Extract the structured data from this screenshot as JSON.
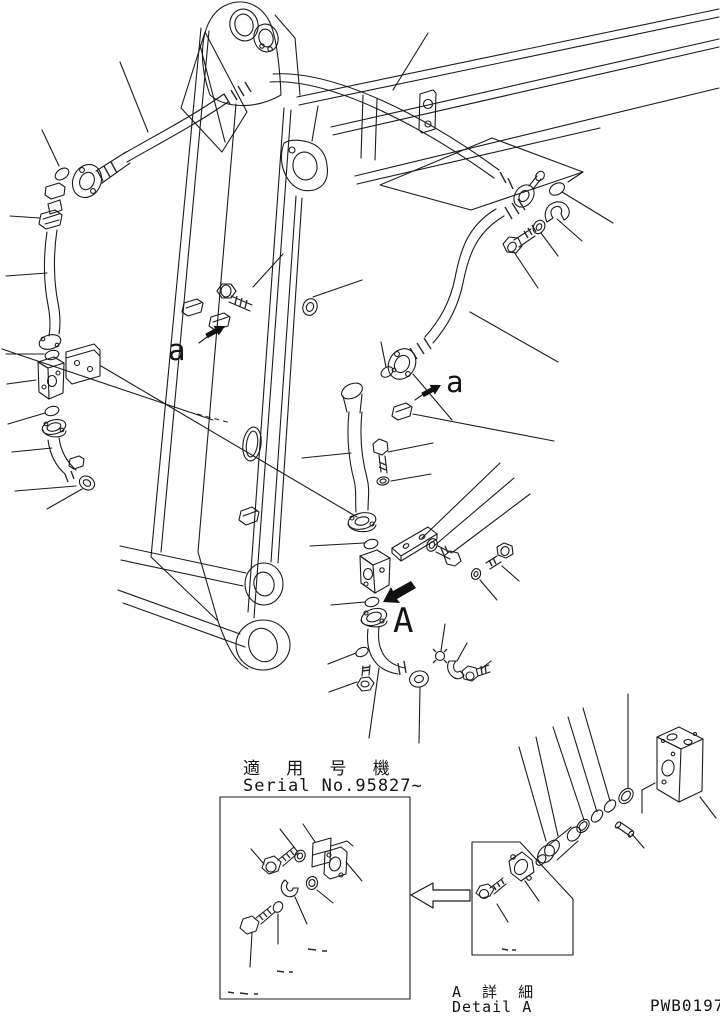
{
  "drawing": {
    "ink": "#1b1b1b",
    "background": "#ffffff",
    "number": "PWB0197",
    "markers": {
      "upper_clamp": "a",
      "lower_clamp": "a",
      "detail_section": "A"
    },
    "serial_note": {
      "title_jp": "適 用 号 機",
      "serial_value": "Serial No.95827~"
    },
    "detail_caption": {
      "title_jp": "A 詳 細",
      "title_en": "Detail A"
    }
  }
}
